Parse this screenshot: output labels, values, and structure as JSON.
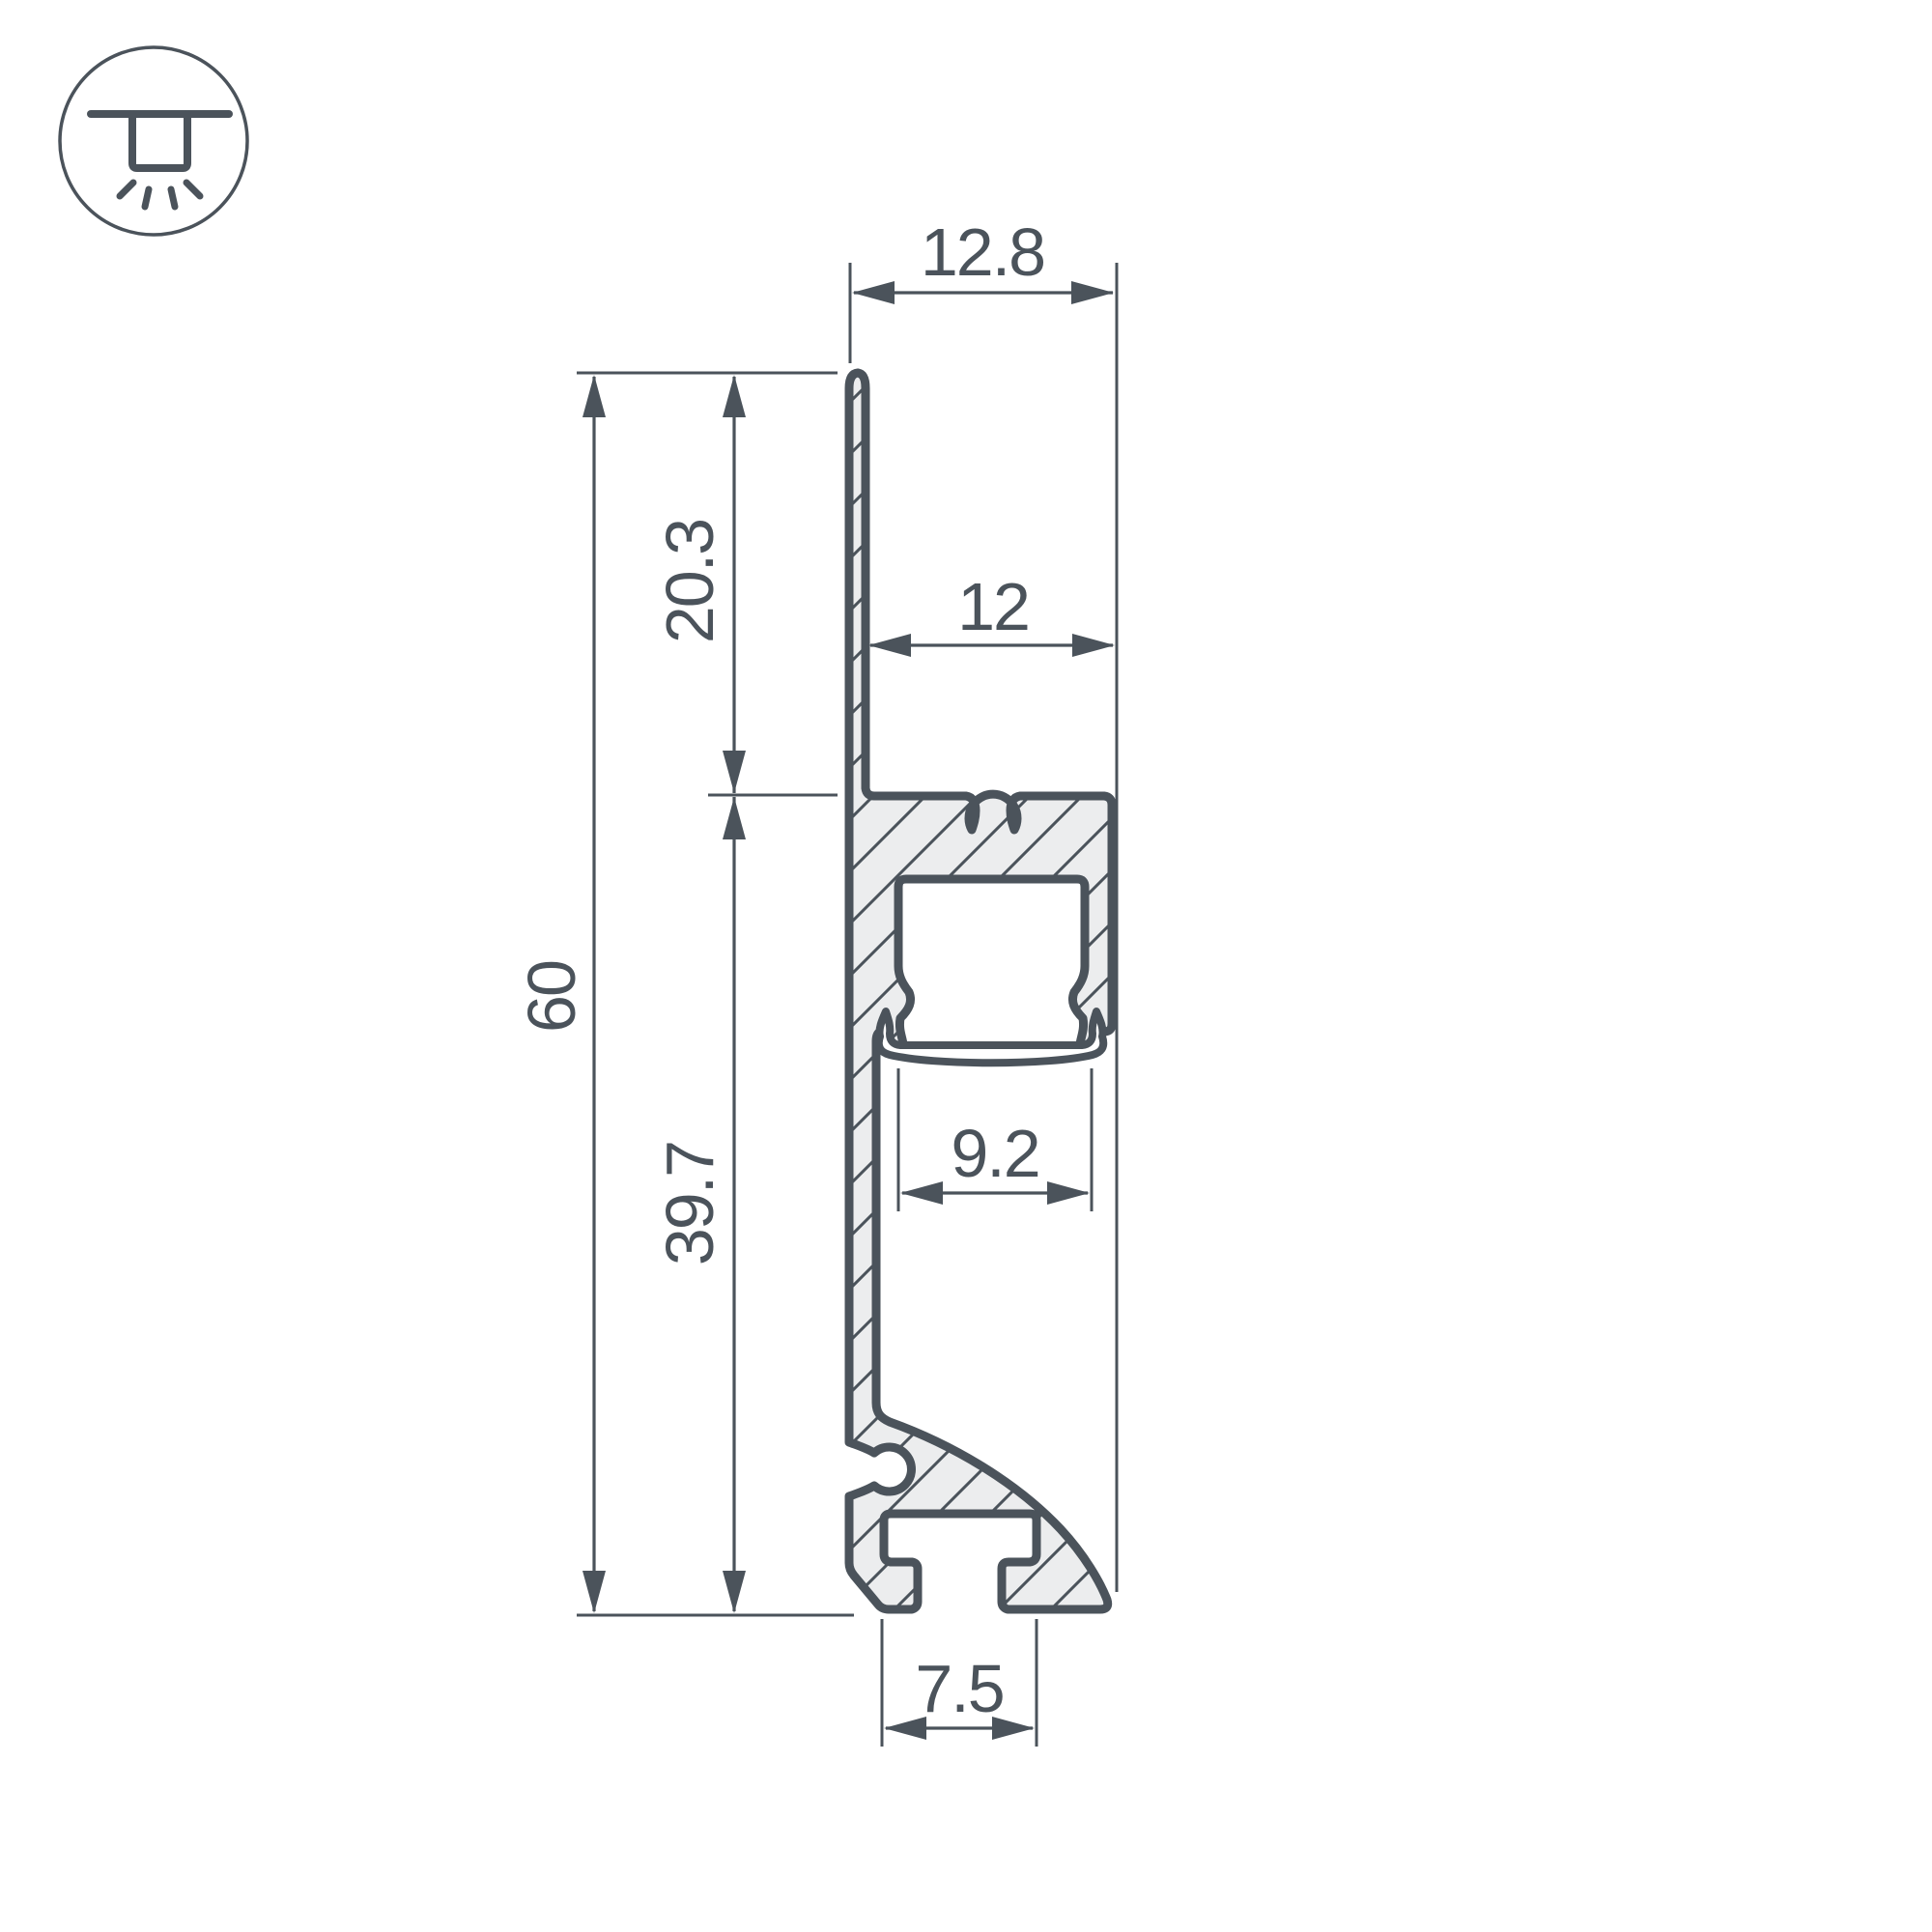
{
  "drawing": {
    "title": "LED profile cross-section",
    "icon": "recessed-downlight-icon",
    "colors": {
      "line": "#4b535b",
      "fill": "#ecedee",
      "background": "#ffffff"
    },
    "dimensions": {
      "top_width": {
        "value": "12.8",
        "orientation": "horizontal"
      },
      "channel_width": {
        "value": "12",
        "orientation": "horizontal"
      },
      "flange_height": {
        "value": "20.3",
        "orientation": "vertical"
      },
      "total_height": {
        "value": "60",
        "orientation": "vertical"
      },
      "body_height": {
        "value": "39.7",
        "orientation": "vertical"
      },
      "opening_width": {
        "value": "9.2",
        "orientation": "horizontal"
      },
      "slot_width": {
        "value": "7.5",
        "orientation": "horizontal"
      }
    }
  }
}
